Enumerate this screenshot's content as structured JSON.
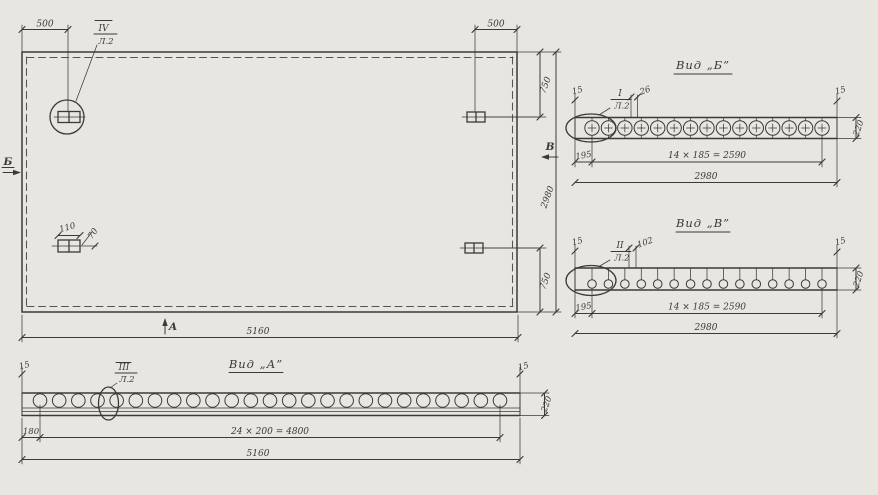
{
  "colors": {
    "paper": "#e8e6e1",
    "ink": "#3c3a36"
  },
  "plan": {
    "section_arrows": {
      "left": "Б",
      "bottom": "А",
      "right": "В"
    },
    "callout_top_left": {
      "ref": "IV",
      "sheet": "Л.2"
    },
    "dims": {
      "offset_left": "500",
      "offset_right": "500",
      "top_750": "750",
      "bottom_750": "750",
      "height": "2980",
      "width": "5160",
      "anchor_width": "110",
      "anchor_offset": "70"
    }
  },
  "view_a": {
    "title": "Вид „А”",
    "callout": {
      "ref": "III",
      "sheet": "Л.2"
    },
    "hole_count": 25,
    "dims": {
      "edge_left": "15",
      "edge_right": "15",
      "first_hole": "180",
      "spacing": "24 × 200 = 4800",
      "total": "5160",
      "thickness": "220"
    }
  },
  "view_b": {
    "title": "Вид „Б”",
    "callout": {
      "ref": "I",
      "sheet": "Л.2"
    },
    "hole_count": 15,
    "dims": {
      "edge_left": "15",
      "edge_right": "15",
      "hole_dia": "26",
      "first_hole": "195",
      "spacing": "14 × 185 = 2590",
      "total": "2980",
      "thickness": "220"
    }
  },
  "view_v": {
    "title": "Вид „В”",
    "callout": {
      "ref": "II",
      "sheet": "Л.2"
    },
    "bolt_count": 15,
    "dims": {
      "edge_left": "15",
      "edge_right": "15",
      "bolt_dia": "102",
      "first_hole": "195",
      "spacing": "14 × 185 = 2590",
      "total": "2980",
      "thickness": "220"
    }
  }
}
